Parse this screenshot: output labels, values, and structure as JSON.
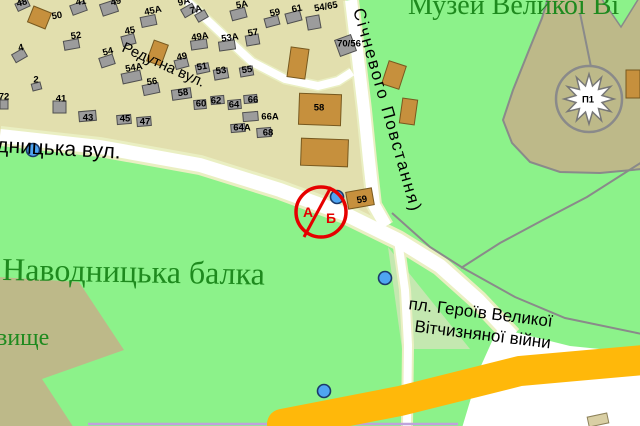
{
  "colors": {
    "park": "#8CF28A",
    "residential": "#E2DFAE",
    "cemetery": "#BDB989",
    "hill": "#BDB989",
    "road_white": "#FFFFFF",
    "road_casing": "#EAEFC2",
    "highway_yellow": "#FFB80A",
    "path_gray": "#8A8A8A",
    "building_gray": "#9C9C9C",
    "building_gray_stroke": "#4F4F4F",
    "building_brown": "#C6903D",
    "building_brown_stroke": "#77591F",
    "label_green": "#1E8A1E",
    "street_label": "#000000",
    "poi_blue": "#4FA5F2",
    "poi_stroke": "#1B3A6B",
    "marker_red": "#E60000",
    "road_purple": "#BFA3DC",
    "monument_star": "#FFFFFF"
  },
  "area_labels": {
    "museum": "Музей Великої Ві",
    "ravine": "Наводницька балка",
    "cemetery_partial": "вище"
  },
  "streets": {
    "redutna": "Редутна вул.",
    "navodnytska_partial": "дницька вул.",
    "sichnevoho": "Січневого Повстання)",
    "square_line1": "пл. Героїв Великої",
    "square_line2": "Вітчизняної війни"
  },
  "marker": {
    "letter_a": "А",
    "letter_b": "Б"
  },
  "building_labels": [
    {
      "t": "48",
      "x": 22,
      "y": 3,
      "r": -15
    },
    {
      "t": "41",
      "x": 81,
      "y": 2,
      "r": -10
    },
    {
      "t": "49",
      "x": 116,
      "y": 2,
      "r": -15
    },
    {
      "t": "45А",
      "x": 153,
      "y": 11,
      "r": -12
    },
    {
      "t": "9А",
      "x": 184,
      "y": 2,
      "r": -15
    },
    {
      "t": "7А",
      "x": 196,
      "y": 10,
      "r": -15
    },
    {
      "t": "5А",
      "x": 242,
      "y": 5,
      "r": -10
    },
    {
      "t": "59",
      "x": 275,
      "y": 13,
      "r": -12
    },
    {
      "t": "61",
      "x": 297,
      "y": 9,
      "r": -12
    },
    {
      "t": "54/65",
      "x": 326,
      "y": 7,
      "r": -10
    },
    {
      "t": "50",
      "x": 57,
      "y": 16,
      "r": -10
    },
    {
      "t": "52",
      "x": 76,
      "y": 36,
      "r": -8
    },
    {
      "t": "4",
      "x": 21,
      "y": 48,
      "r": -12
    },
    {
      "t": "45",
      "x": 130,
      "y": 31,
      "r": -10
    },
    {
      "t": "54",
      "x": 108,
      "y": 52,
      "r": -15
    },
    {
      "t": "54А",
      "x": 134,
      "y": 68,
      "r": -10
    },
    {
      "t": "49А",
      "x": 200,
      "y": 37,
      "r": -8
    },
    {
      "t": "53А",
      "x": 230,
      "y": 38,
      "r": -8
    },
    {
      "t": "57",
      "x": 253,
      "y": 33,
      "r": -10
    },
    {
      "t": "49",
      "x": 182,
      "y": 57,
      "r": -12
    },
    {
      "t": "51",
      "x": 202,
      "y": 67,
      "r": -10
    },
    {
      "t": "53",
      "x": 221,
      "y": 71,
      "r": -8
    },
    {
      "t": "55",
      "x": 247,
      "y": 70,
      "r": -8
    },
    {
      "t": "56",
      "x": 152,
      "y": 82,
      "r": -8
    },
    {
      "t": "58",
      "x": 183,
      "y": 93,
      "r": -8
    },
    {
      "t": "60",
      "x": 201,
      "y": 104,
      "r": 0
    },
    {
      "t": "62",
      "x": 216,
      "y": 101,
      "r": 0
    },
    {
      "t": "64",
      "x": 234,
      "y": 105,
      "r": 0
    },
    {
      "t": "66",
      "x": 253,
      "y": 100,
      "r": 0
    },
    {
      "t": "66А",
      "x": 270,
      "y": 117,
      "r": 0
    },
    {
      "t": "64А",
      "x": 242,
      "y": 128,
      "r": 0
    },
    {
      "t": "68",
      "x": 268,
      "y": 133,
      "r": 0
    },
    {
      "t": "2",
      "x": 36,
      "y": 80,
      "r": 0
    },
    {
      "t": "72",
      "x": 4,
      "y": 97,
      "r": 0
    },
    {
      "t": "41",
      "x": 61,
      "y": 99,
      "r": 0
    },
    {
      "t": "43",
      "x": 88,
      "y": 118,
      "r": 0
    },
    {
      "t": "45",
      "x": 125,
      "y": 119,
      "r": 0
    },
    {
      "t": "47",
      "x": 145,
      "y": 122,
      "r": 0
    },
    {
      "t": "70/56",
      "x": 349,
      "y": 44,
      "r": 0
    },
    {
      "t": "58",
      "x": 319,
      "y": 108,
      "r": 0
    },
    {
      "t": "59",
      "x": 362,
      "y": 200,
      "r": -10
    },
    {
      "t": "П1",
      "x": 588,
      "y": 100,
      "r": 0
    },
    {
      "t": ".",
      "x": 336,
      "y": 5,
      "r": 0
    }
  ],
  "buildings": {
    "gray": [
      [
        16,
        1,
        13,
        8,
        -25
      ],
      [
        71,
        3,
        15,
        10,
        -20
      ],
      [
        101,
        2,
        16,
        12,
        -18
      ],
      [
        141,
        16,
        15,
        10,
        -12
      ],
      [
        182,
        6,
        13,
        9,
        -30
      ],
      [
        196,
        12,
        11,
        8,
        -30
      ],
      [
        231,
        9,
        15,
        10,
        -15
      ],
      [
        265,
        17,
        14,
        9,
        -15
      ],
      [
        286,
        12,
        15,
        10,
        -15
      ],
      [
        307,
        16,
        13,
        13,
        -10
      ],
      [
        64,
        40,
        15,
        9,
        -10
      ],
      [
        13,
        51,
        13,
        9,
        -30
      ],
      [
        32,
        83,
        9,
        7,
        -15
      ],
      [
        0,
        100,
        8,
        9,
        0
      ],
      [
        122,
        35,
        13,
        10,
        -15
      ],
      [
        100,
        56,
        14,
        10,
        -18
      ],
      [
        122,
        72,
        19,
        10,
        -12
      ],
      [
        143,
        84,
        16,
        10,
        -12
      ],
      [
        172,
        89,
        19,
        10,
        -8
      ],
      [
        191,
        40,
        16,
        9,
        -8
      ],
      [
        219,
        41,
        16,
        9,
        -8
      ],
      [
        246,
        35,
        13,
        10,
        -10
      ],
      [
        175,
        59,
        13,
        9,
        -15
      ],
      [
        196,
        64,
        13,
        9,
        -12
      ],
      [
        214,
        69,
        14,
        10,
        -10
      ],
      [
        240,
        67,
        13,
        9,
        -10
      ],
      [
        194,
        100,
        12,
        9,
        -5
      ],
      [
        211,
        96,
        13,
        8,
        -5
      ],
      [
        228,
        100,
        13,
        9,
        -5
      ],
      [
        244,
        95,
        13,
        8,
        -5
      ],
      [
        243,
        112,
        15,
        9,
        -5
      ],
      [
        231,
        124,
        14,
        8,
        -5
      ],
      [
        257,
        128,
        14,
        9,
        -5
      ],
      [
        53,
        101,
        13,
        12,
        0
      ],
      [
        79,
        111,
        17,
        10,
        -5
      ],
      [
        117,
        115,
        14,
        9,
        -5
      ],
      [
        137,
        117,
        14,
        9,
        -5
      ],
      [
        337,
        37,
        17,
        17,
        -20
      ]
    ],
    "brown": [
      [
        30,
        9,
        19,
        17,
        22
      ],
      [
        150,
        42,
        15,
        22,
        20
      ],
      [
        289,
        48,
        18,
        30,
        8
      ],
      [
        299,
        94,
        42,
        31,
        2
      ],
      [
        301,
        139,
        47,
        27,
        2
      ],
      [
        385,
        63,
        18,
        24,
        18
      ],
      [
        401,
        99,
        15,
        25,
        8
      ],
      [
        347,
        190,
        26,
        17,
        -10
      ],
      [
        626,
        70,
        14,
        28,
        0
      ]
    ],
    "pale": [
      [
        588,
        415,
        20,
        10,
        -12
      ]
    ]
  },
  "poi_dots": [
    {
      "x": 33,
      "y": 150
    },
    {
      "x": 337,
      "y": 197
    },
    {
      "x": 385,
      "y": 278
    },
    {
      "x": 324,
      "y": 391
    }
  ]
}
